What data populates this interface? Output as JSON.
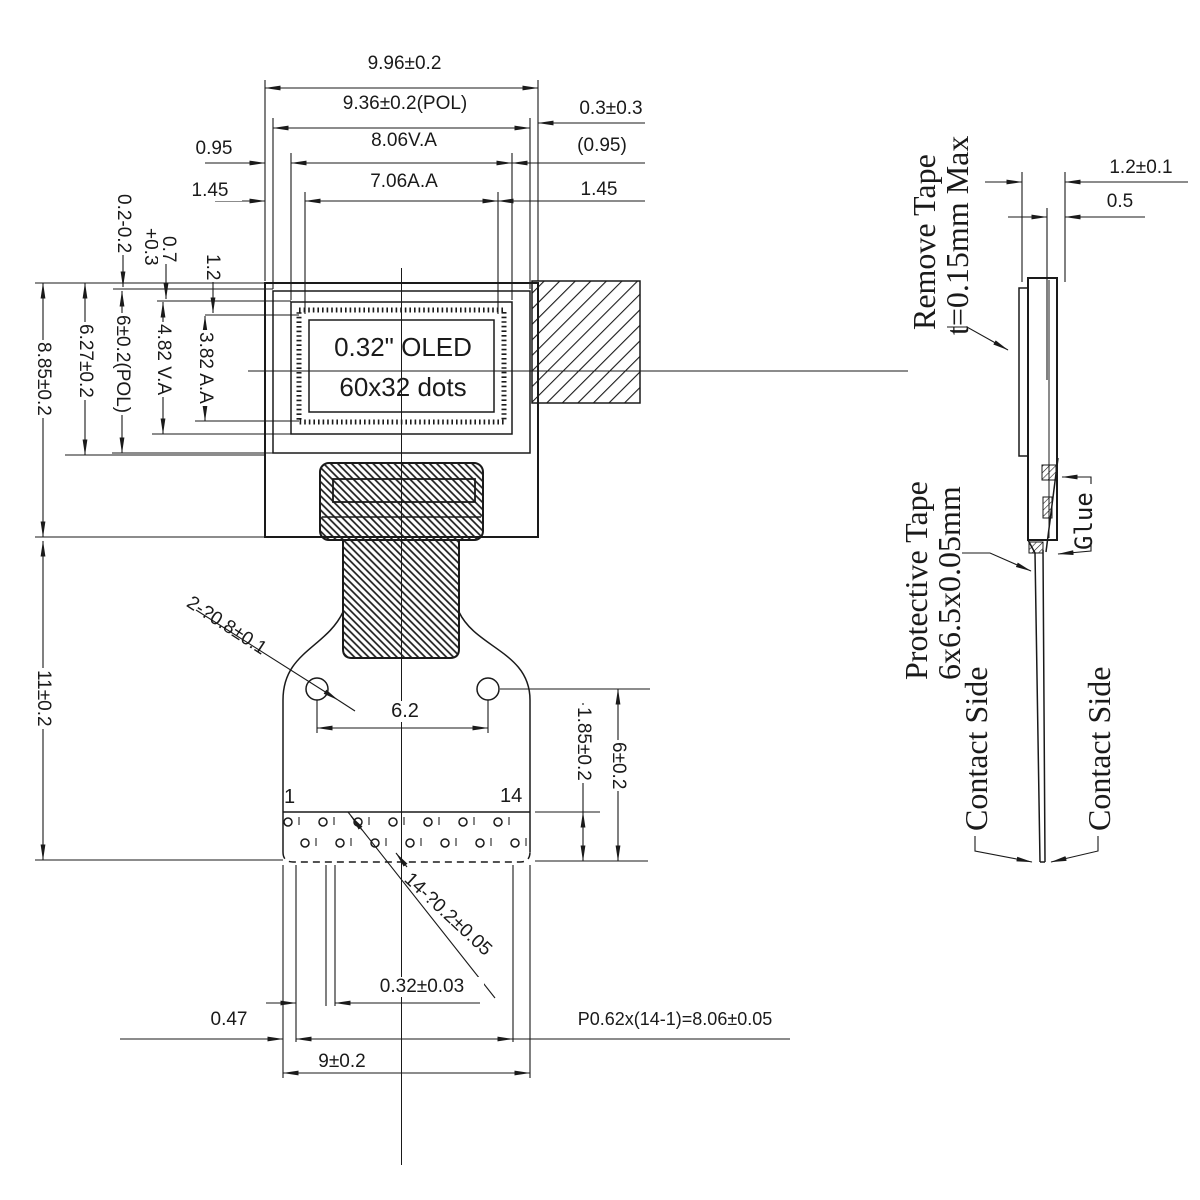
{
  "front": {
    "top": {
      "overall": "9.96±0.2",
      "pol": "9.36±0.2(POL)",
      "pol_gap": "0.3±0.3",
      "va_margin_left": "0.95",
      "va": "8.06V.A",
      "va_margin_right": "(0.95)",
      "aa_margin_left": "1.45",
      "aa": "7.06A.A",
      "aa_margin_right": "1.45"
    },
    "left": {
      "glass_h": "8.85±0.2",
      "disp_h": "6.27±0.2",
      "pol_h": "6±0.2(POL)",
      "va_h": "4.82 V.A",
      "aa_h": "3.82 A.A",
      "tail_h": "11±0.2",
      "pol_top": "0.2-0.2",
      "va_top": "0.7",
      "va_top_tol": "+0.3",
      "aa_top": "1.2"
    },
    "display": {
      "line1": "0.32\" OLED",
      "line2": "60x32 dots"
    },
    "holes": {
      "callout": "2-?0.8±0.1",
      "pitch": "6.2"
    },
    "pads": {
      "pin_first": "1",
      "pin_last": "14",
      "callout": "14-?0.2±0.05",
      "pad_dim": "0.32±0.03",
      "offset": "0.47",
      "pitch_eq": "P0.62x(14-1)=8.06±0.05",
      "body_w": "9±0.2",
      "zone_h": "1.85±0.2",
      "hole_edge": "6±0.2"
    }
  },
  "side": {
    "dims": {
      "thickness": "1.2±0.1",
      "glass": "0.5"
    },
    "labels": {
      "remove1": "Remove Tape",
      "remove2": "t=0.15mm Max",
      "prot1": "Protective Tape",
      "prot2": "6x6.5x0.05mm",
      "glue": "Glue",
      "contact_l": "Contact Side",
      "contact_r": "Contact Side"
    }
  },
  "colors": {
    "ink": "#1a1a1a",
    "paper": "#ffffff"
  }
}
